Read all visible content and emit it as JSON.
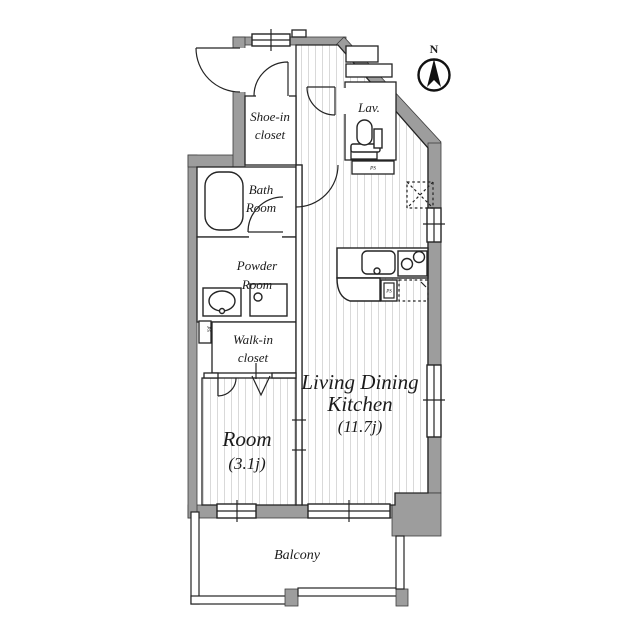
{
  "title": "apartment-floor-plan",
  "colors": {
    "wall": "#9d9d9d",
    "wall_outline": "#3d3d3d",
    "line": "#242424",
    "floor_stripe": "#d9d9d9",
    "text": "#1b1b1b"
  },
  "compass": {
    "north_label": "N"
  },
  "rooms": {
    "shoe_in_closet": {
      "line1": "Shoe-in",
      "line2": "closet"
    },
    "lav": {
      "label": "Lav."
    },
    "bath_room": {
      "line1": "Bath",
      "line2": "Room"
    },
    "powder_room": {
      "line1": "Powder",
      "line2": "Room"
    },
    "walk_in_closet": {
      "line1": "Walk-in",
      "line2": "closet"
    },
    "room": {
      "name": "Room",
      "size": "(3.1j)"
    },
    "ldk": {
      "line1": "Living Dining",
      "line2": "Kitchen",
      "size": "(11.7j)"
    },
    "balcony": {
      "label": "Balcony"
    }
  },
  "labels": {
    "ps_lav": "PS",
    "ps_left": "PS",
    "ps_kitchen": "PS"
  }
}
